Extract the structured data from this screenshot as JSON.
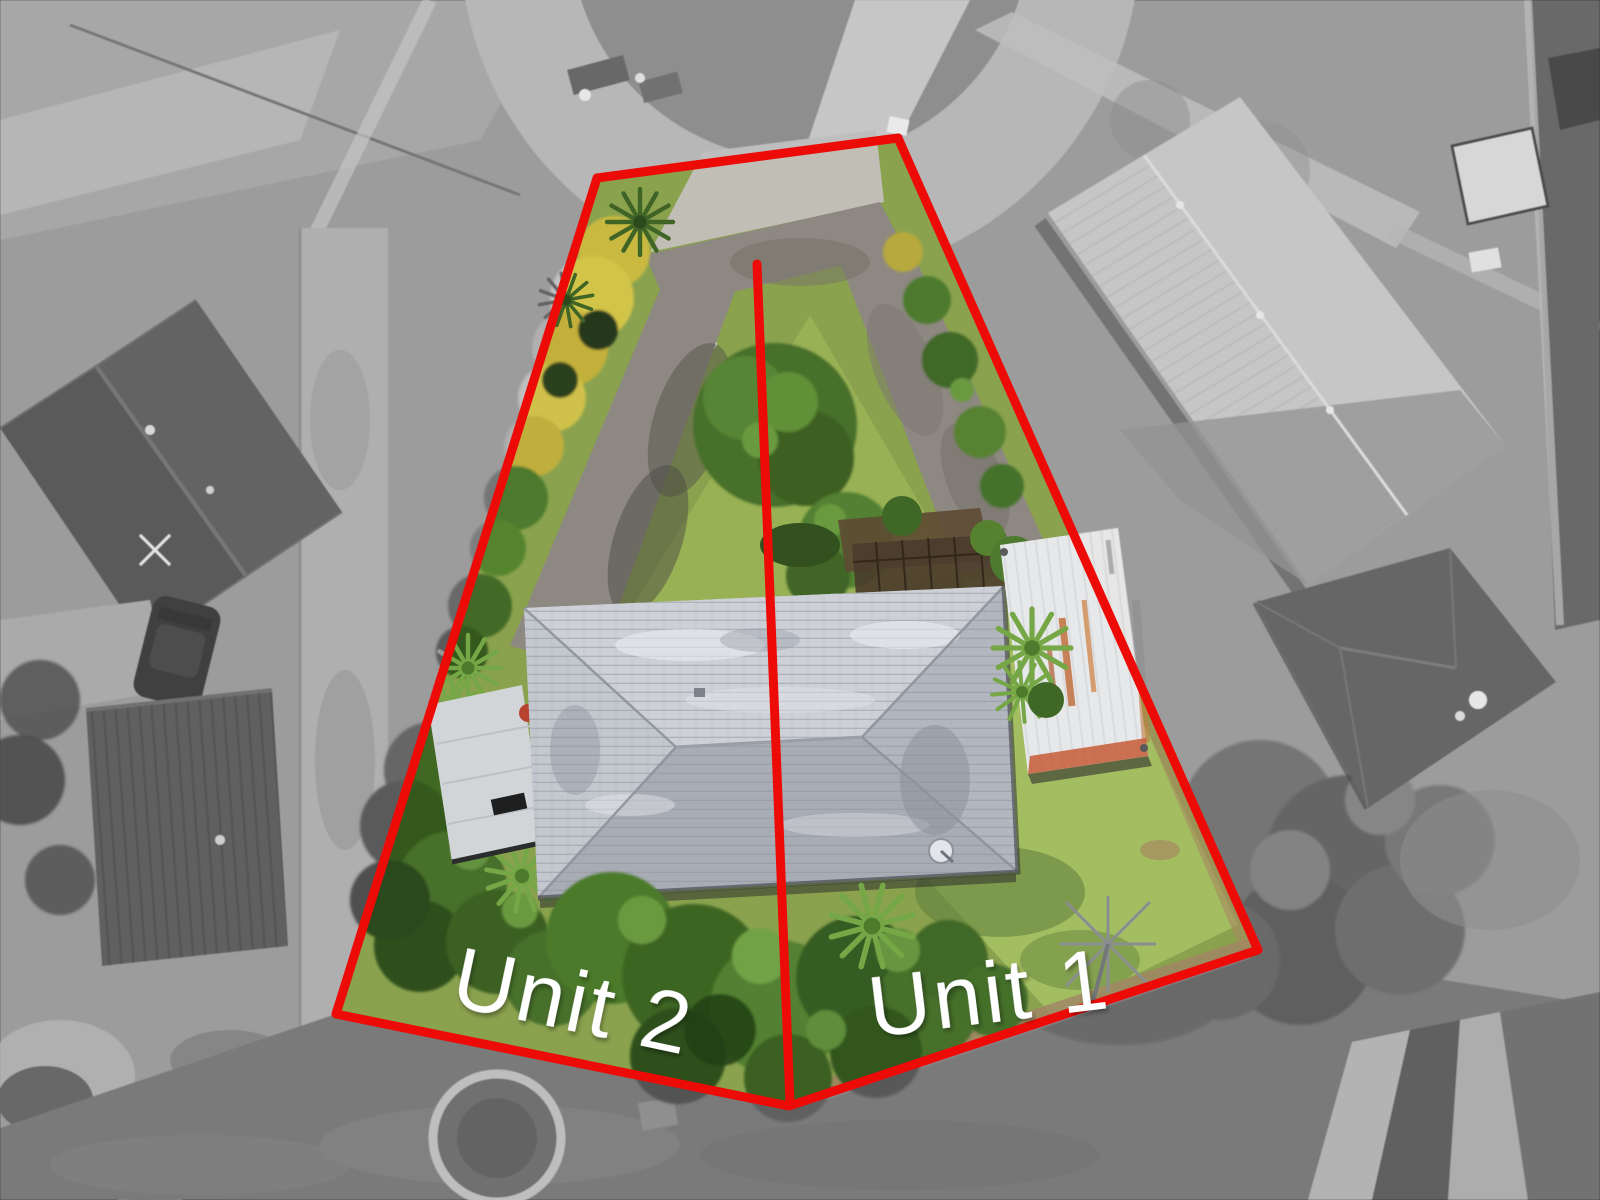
{
  "meta": {
    "type": "aerial-drone-property-photo",
    "width_px": 1600,
    "height_px": 1200,
    "description": "Aerial photo of a subdivided residential section; surroundings desaturated, lot in colour, red survey overlay"
  },
  "annotations": {
    "accent_color": "#ec0b06",
    "label_color": "#ffffff",
    "label_font_size": 86,
    "line_width": 9,
    "boundary_points": "597,178 898,138 1258,950 789,1106 336,1014",
    "divider_line": {
      "x1": 757,
      "y1": 264,
      "x2": 790,
      "y2": 1103
    },
    "labels": [
      {
        "id": "unit2",
        "text": "Unit 2",
        "x": 572,
        "y": 1008,
        "rotation": 12
      },
      {
        "id": "unit1",
        "text": "Unit 1",
        "x": 990,
        "y": 1000,
        "rotation": -7
      }
    ]
  },
  "palette": {
    "lot_grass": "#8aa24e",
    "bright_lawn": "#a3bd61",
    "driveway": "#8d8881",
    "house_roof": "#b9bdc5",
    "shed_rust": "#c65a36",
    "kowhai_yellow": "#d2c44a",
    "dirt_edge": "#a08666",
    "surroundings_gray": "#9a9a9a"
  }
}
